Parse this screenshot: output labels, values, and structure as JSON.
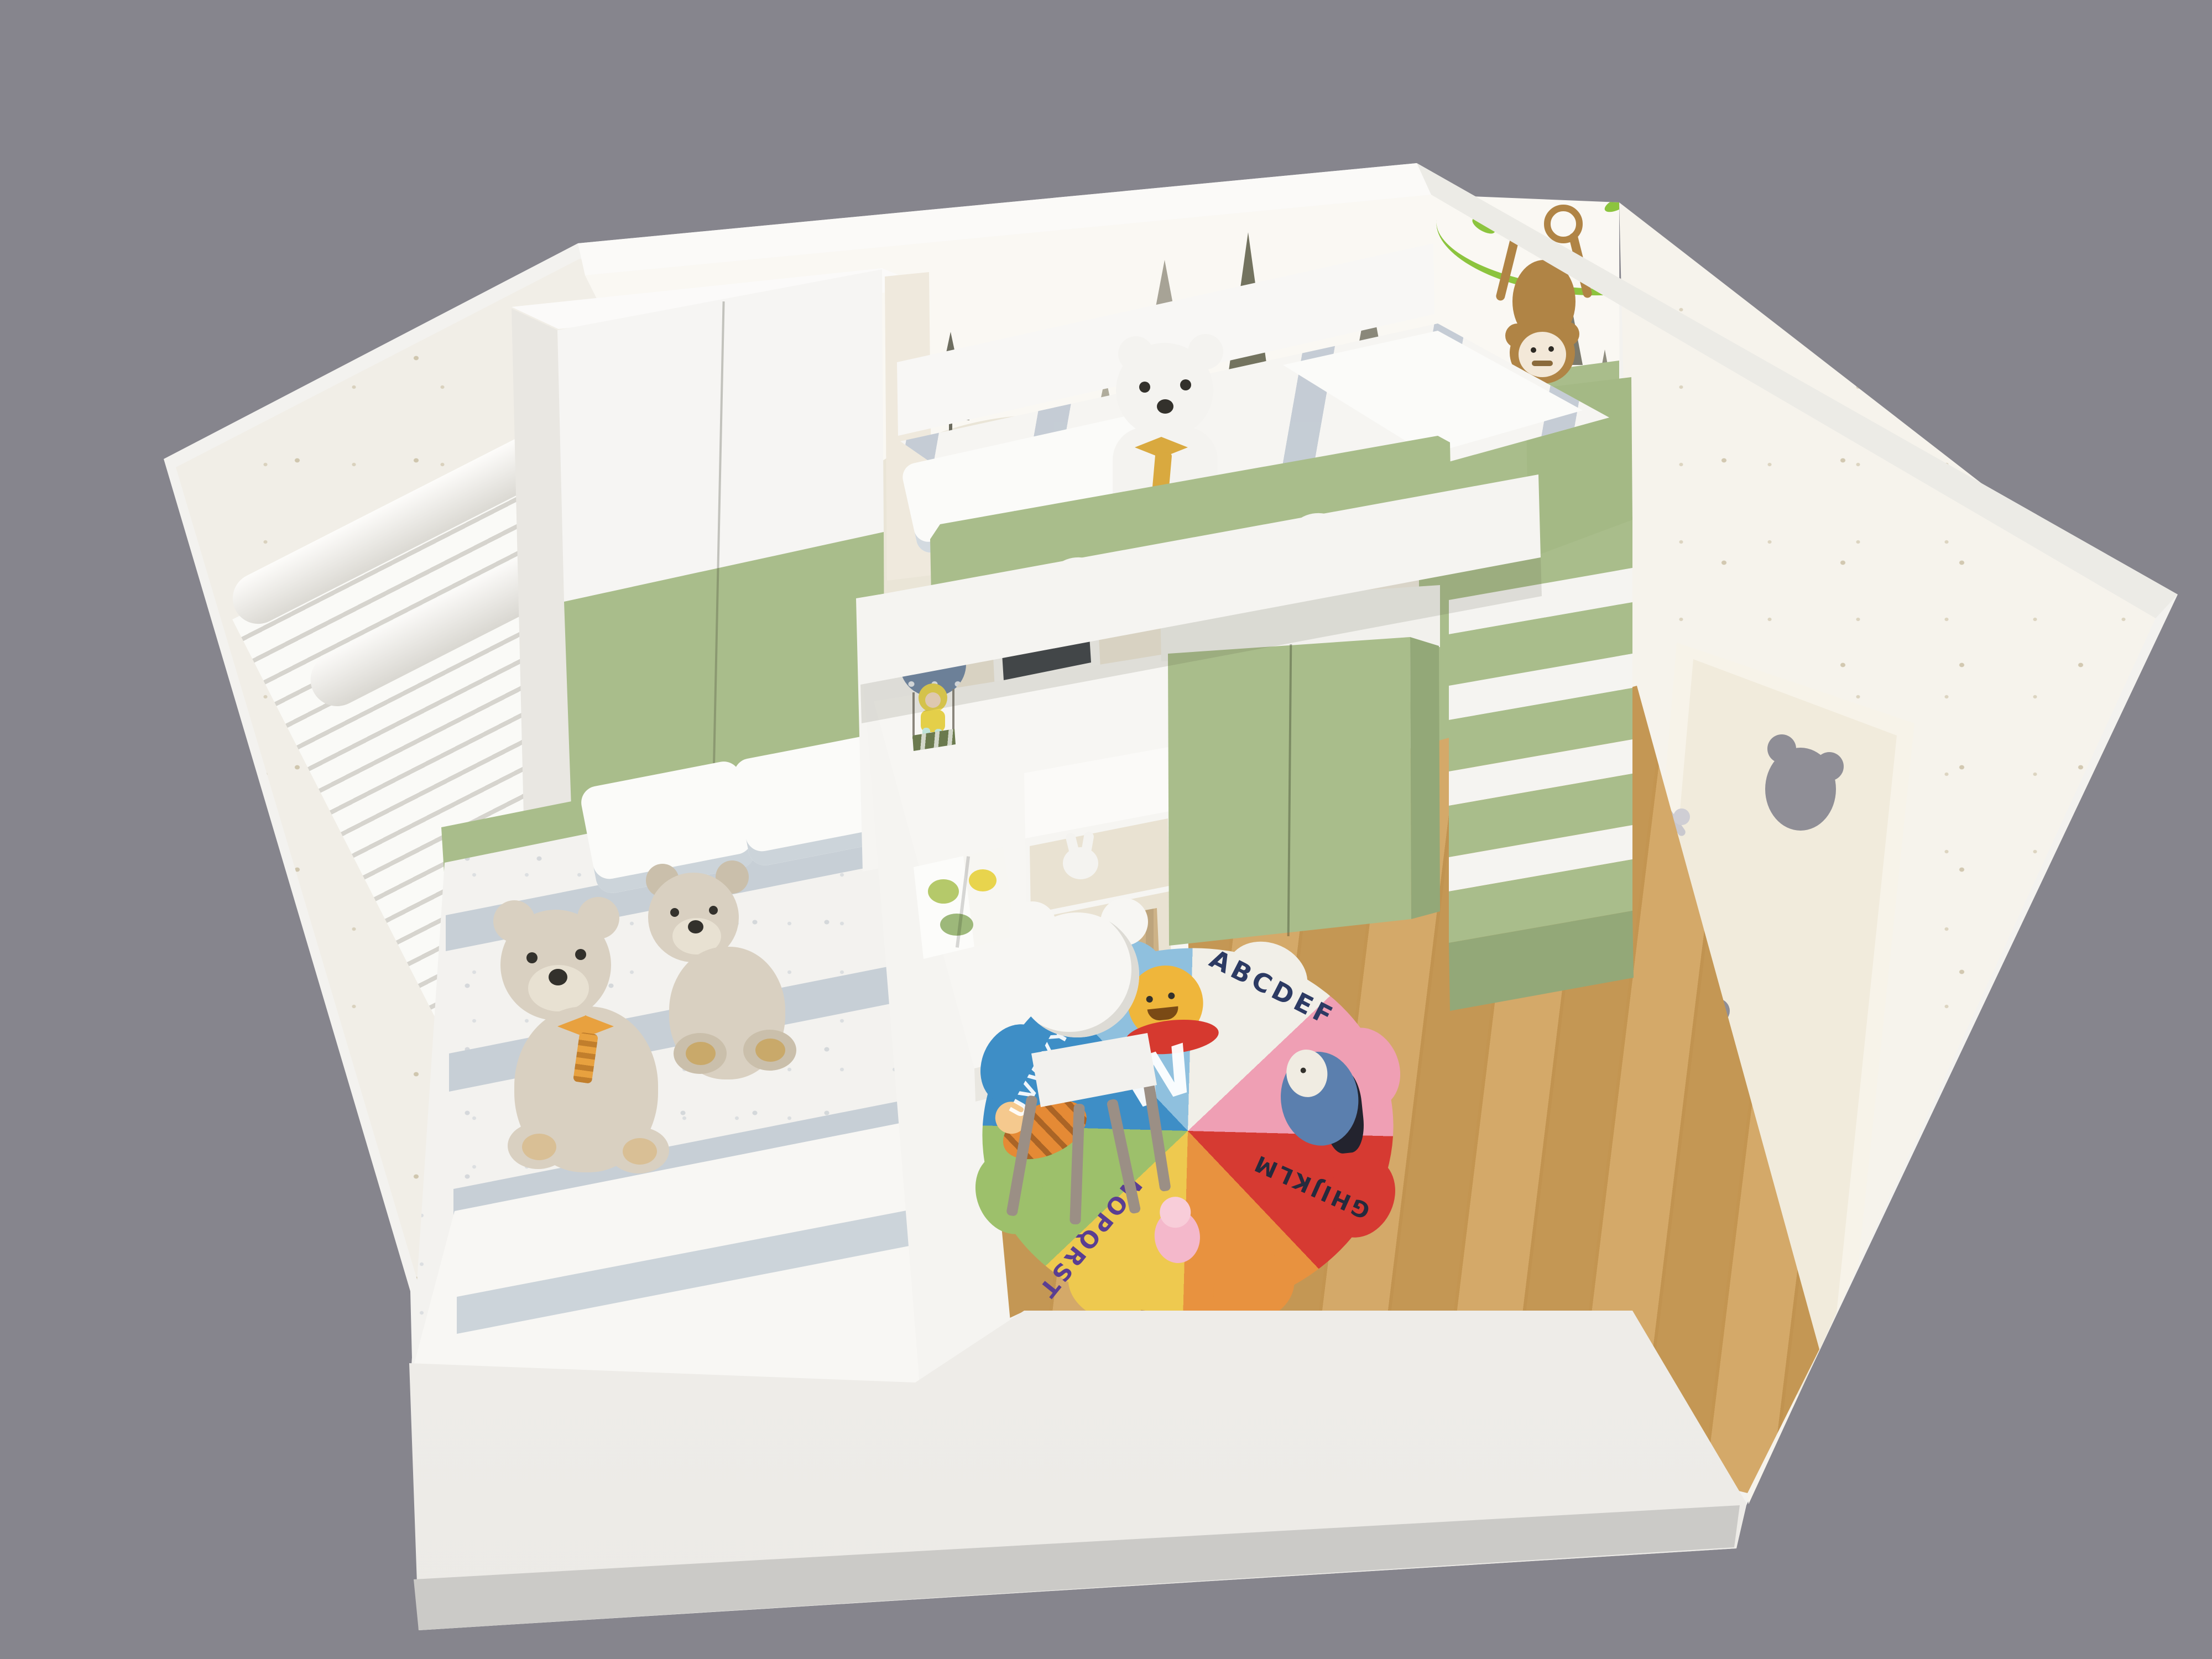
{
  "scene": {
    "description": "isometric cutaway 3D render of a children's bedroom",
    "background_color": "#86858d",
    "wall_color": "#f3f2ef",
    "accent_green": "#a9bd8b",
    "wood_floor_color": "#cf9f58"
  },
  "rug": {
    "shape": "scalloped flower, 8 color wedges",
    "wedge_colors": [
      "#3e8ec6",
      "#8fc0de",
      "#f1efe8",
      "#ef9fb4",
      "#d63a32",
      "#e8923f",
      "#eec94f",
      "#9dc06b"
    ],
    "letters": {
      "top_right": "ABCDEF",
      "bottom_right": "GHIJKLM",
      "bottom_left": "NOPQRST",
      "top_left": "UVWXYZ",
      "center_large": "W"
    },
    "characters": [
      "winnie-the-pooh",
      "eeyore",
      "piglet",
      "tigger"
    ]
  },
  "decor": {
    "wall_mural": "beige mountains with pine trees",
    "wall_decals": "two monkeys hanging from green vine",
    "door_cutouts": 2,
    "teddy_bears_lower_bed": 2,
    "teddy_bears_loft": 1,
    "stair_steps": 5
  }
}
